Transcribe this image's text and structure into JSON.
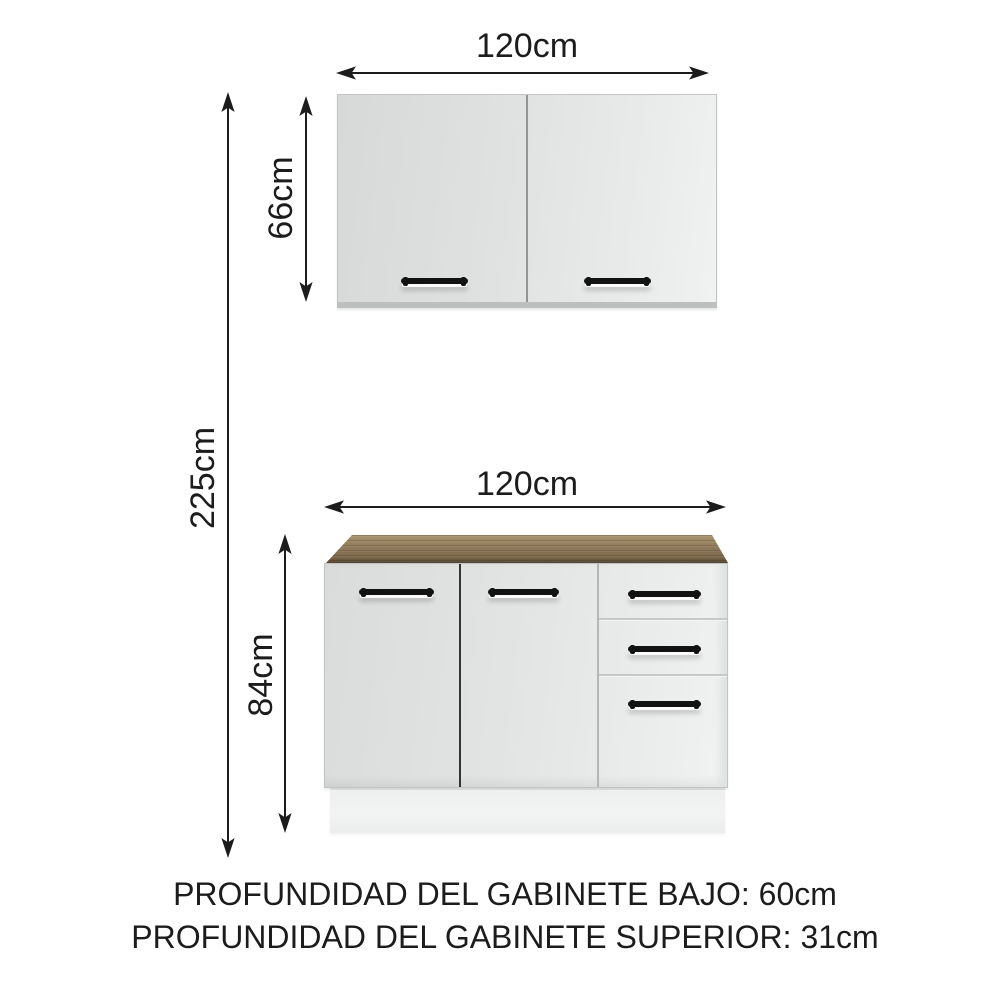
{
  "diagram_labels": {
    "upper_cabinet_width": "120cm",
    "upper_cabinet_height": "66cm",
    "total_height": "225cm",
    "lower_cabinet_width": "120cm",
    "lower_cabinet_height": "84cm"
  },
  "footer": {
    "line1": "PROFUNDIDAD DEL GABINETE BAJO: 60cm",
    "line2": "PROFUNDIDAD DEL GABINETE SUPERIOR: 31cm"
  },
  "colors": {
    "background": "#ffffff",
    "text": "#1c1c1c",
    "arrow": "#1c1c1c",
    "cabinet_face": "#dfe1e1",
    "cabinet_edge": "#c3c5c5",
    "door_gap_dark": "#343434",
    "divider_light": "#b5b7b7",
    "handle": "#121212",
    "countertop_light": "#ab9671",
    "countertop_mid": "#8a7557",
    "countertop_dark": "#51422d",
    "plinth": "#f0f1f1"
  }
}
